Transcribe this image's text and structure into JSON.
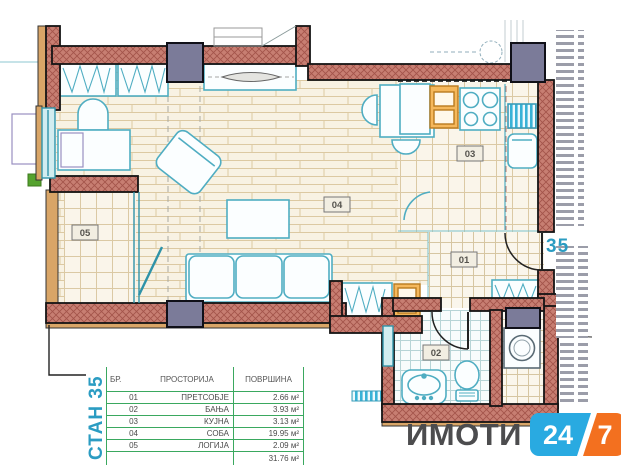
{
  "plan": {
    "apartment_label": "СТАН 35",
    "unit_number": "35",
    "labels": {
      "hall": "01",
      "bath": "02",
      "kitchen": "03",
      "living": "04",
      "loggia": "05"
    }
  },
  "table": {
    "headers": {
      "no": "БР.",
      "room": "ПРОСТОРИЈА",
      "area": "ПОВРШИНА"
    },
    "rows": [
      {
        "no": "01",
        "room": "ПРЕТСОБЈЕ",
        "area": "2.66 м²"
      },
      {
        "no": "02",
        "room": "БАЊА",
        "area": "3.93 м²"
      },
      {
        "no": "03",
        "room": "КУЈНА",
        "area": "3.13 м²"
      },
      {
        "no": "04",
        "room": "СОБА",
        "area": "19.95 м²"
      },
      {
        "no": "05",
        "room": "ЛОГИЈА",
        "area": "2.09 м²"
      }
    ],
    "total_area": "31.76 м²"
  },
  "logo": {
    "brand": "ИМОТИ",
    "badge_blue": "24",
    "badge_orange": "7"
  },
  "colors": {
    "wall_salmon": "#c77e72",
    "wall_tan": "#d9a567",
    "column_slate": "#7b7b99",
    "furniture_teal": "#4fadc2",
    "table_green": "#3aa85f",
    "apartment_blue": "#2b9cc2",
    "logo_gray": "#4c4c4e",
    "logo_blue": "#29aae1",
    "logo_orange": "#f3701f"
  }
}
